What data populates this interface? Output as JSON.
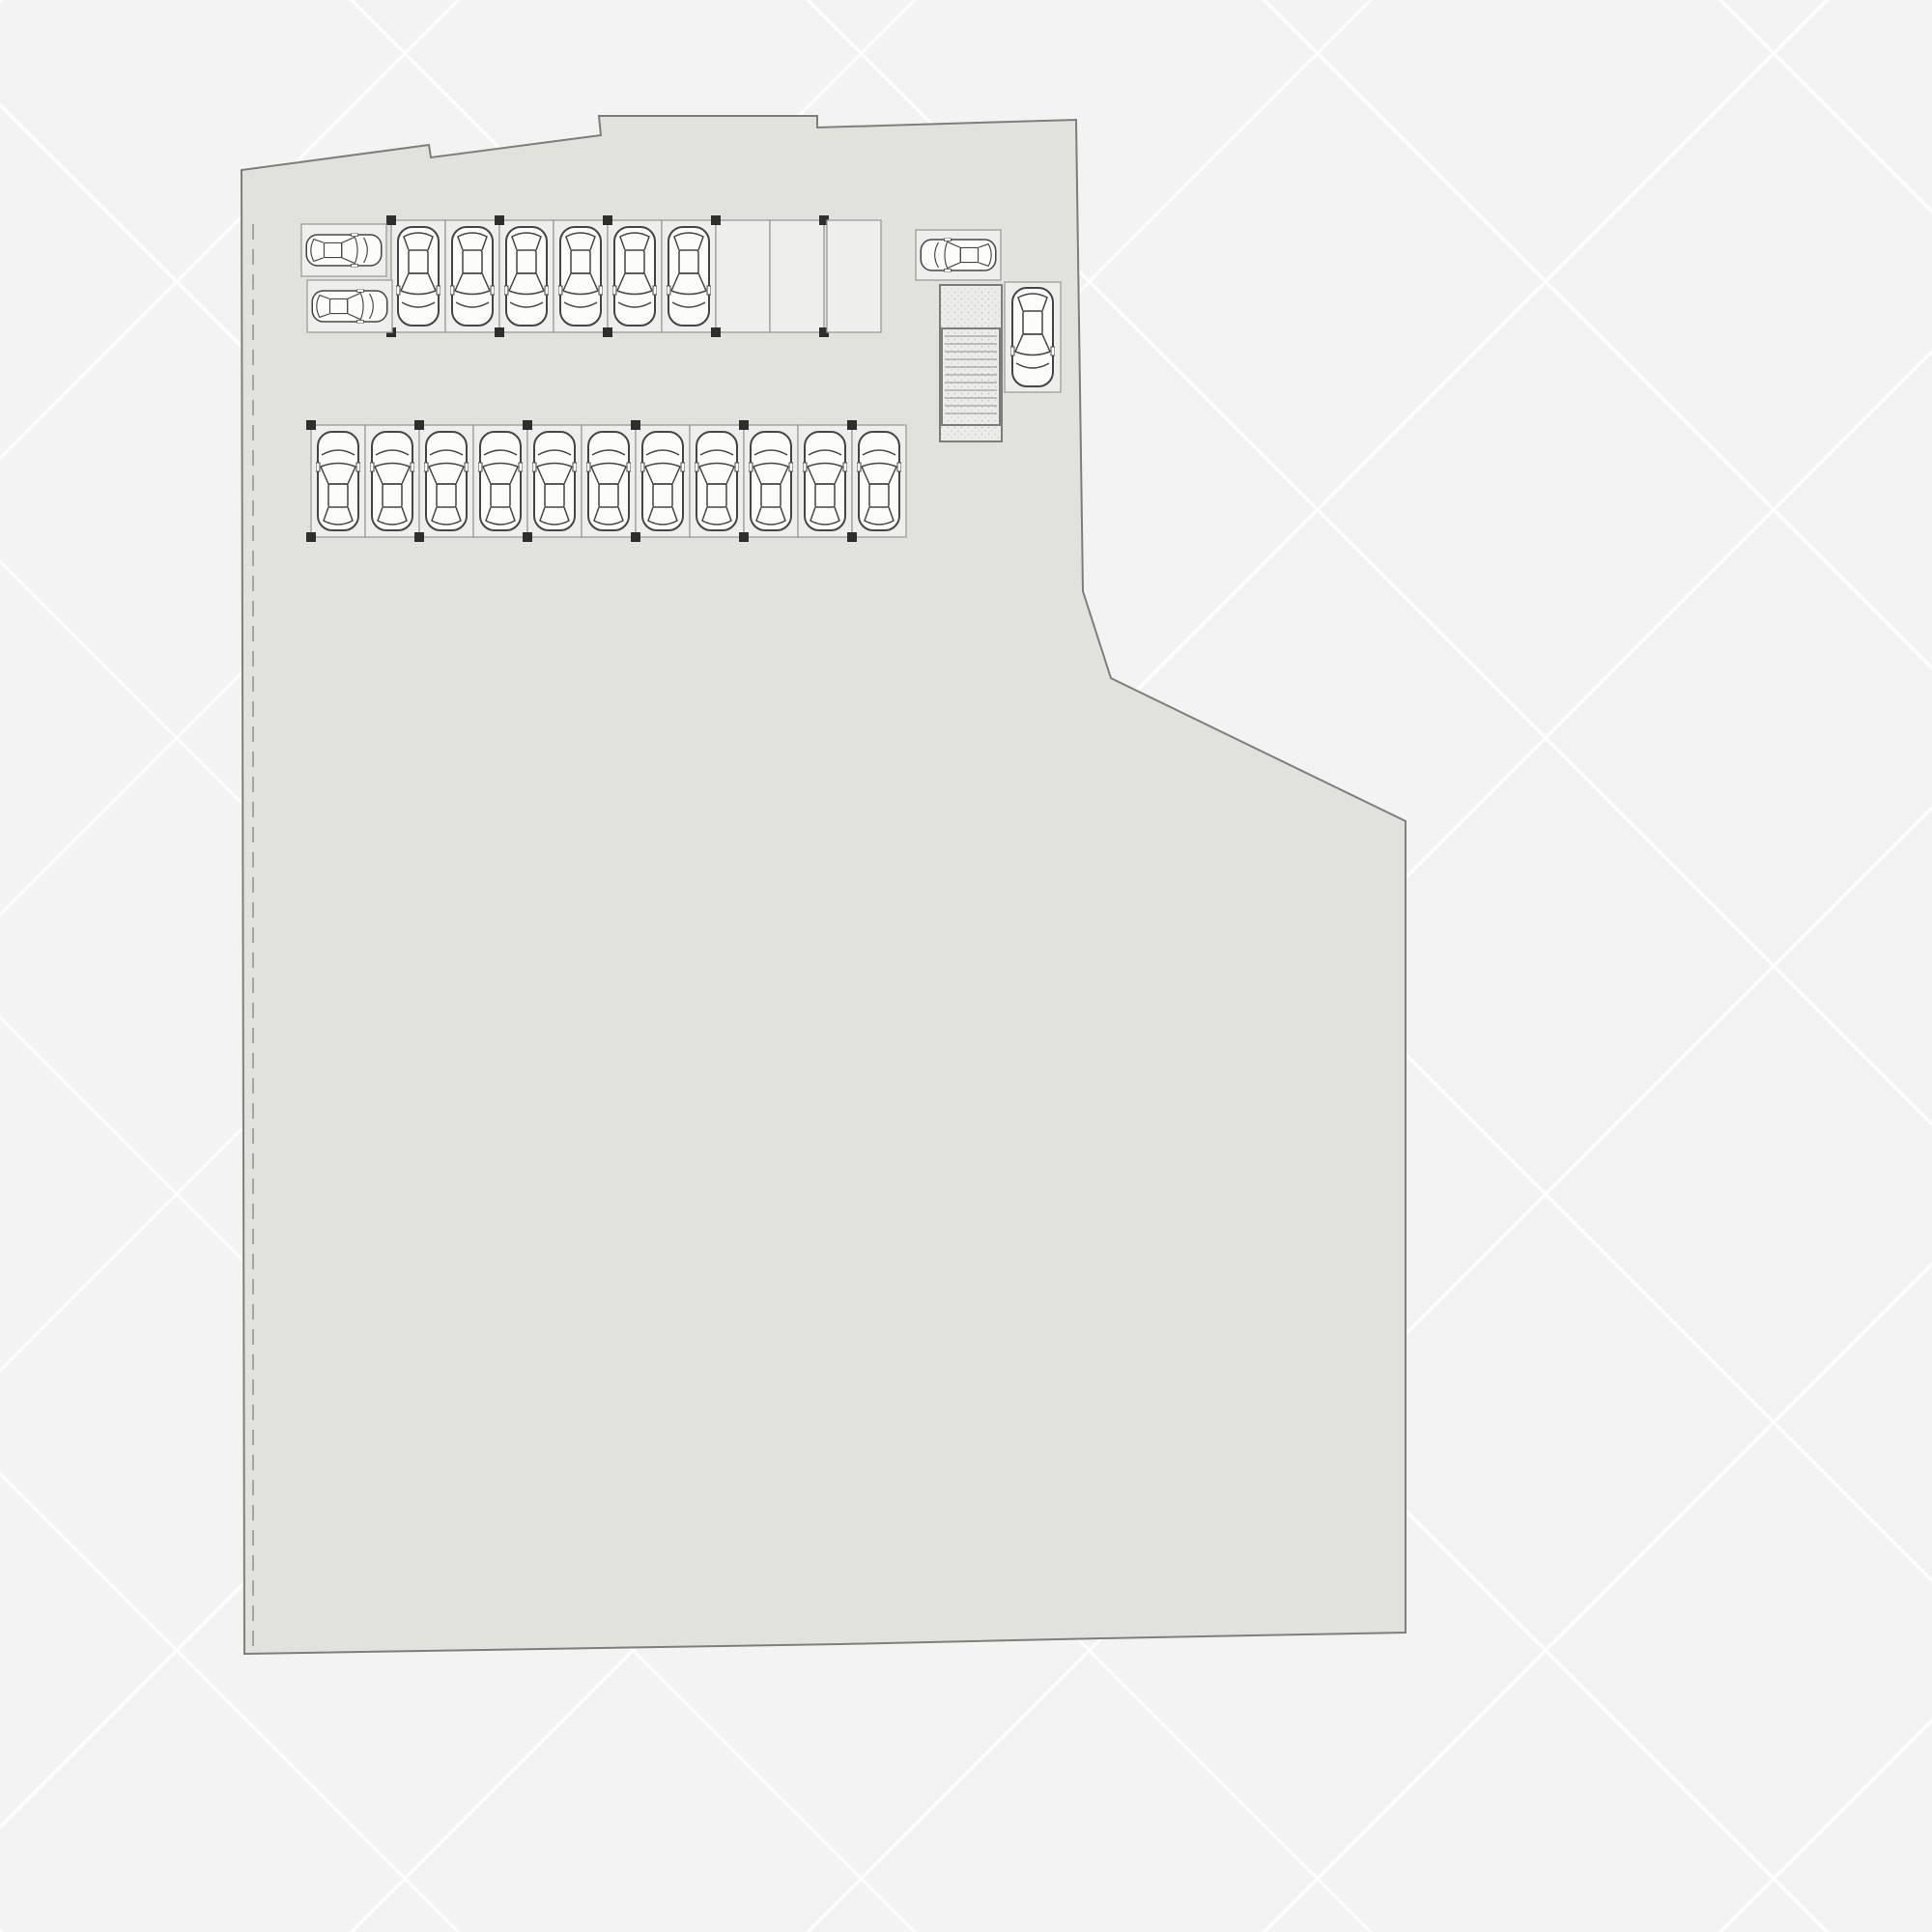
{
  "title": "SITE CUM STILT FLOOR PLAN",
  "scale_note": "*NOT TO SCALE",
  "compass": {
    "north": "N",
    "east": "E",
    "south": "S",
    "west": "W"
  },
  "road": {
    "name": "9M WIDE ROAD"
  },
  "blocks": [
    {
      "id": "block-a",
      "label": "BLOCK -A"
    },
    {
      "id": "block-b",
      "label": "BLOCK -B"
    },
    {
      "id": "block-c",
      "label": "BLOCK -C"
    }
  ],
  "rooms": {
    "communication": {
      "lines": [
        "Communi",
        "cation",
        "Room"
      ]
    },
    "lobby": {
      "label": "LOBBY"
    },
    "lift": {
      "label": "LIFT"
    },
    "electrical_a": {
      "lines": [
        "ELECTRICAL",
        "ROOM-A"
      ]
    },
    "electrical_b": {
      "lines": [
        "ELECTRICAL",
        "ROOM-B"
      ]
    },
    "electrical_c": {
      "lines": [
        "ELECTRICAL",
        "ROOM-C"
      ]
    },
    "generator": {
      "label": "GENERATOR"
    },
    "toilet": {
      "label": "TOILET"
    },
    "maintenance": {
      "lines": [
        "MAINTENANCE",
        "ROOM"
      ]
    },
    "security": {
      "lines": [
        "SECURITY",
        "CABIN"
      ]
    },
    "transformer": {
      "label": "TRANSFORMER"
    }
  },
  "markers": {
    "up": "UP",
    "entry": "ENTRY",
    "exit": "EXIT"
  },
  "palette": {
    "navy": "#18223d",
    "road": "#57575a",
    "plan_fill": "#e2e2dd",
    "stall_fill": "#eeeeec",
    "room_pink": "#f2d7cc",
    "lift_pink": "#f8c9cc",
    "generator_tan": "#d8a66e",
    "toilet_blue": "#bfe1e8",
    "transformer_green": "#e6edb4",
    "title_gray": "#3d3d40"
  }
}
